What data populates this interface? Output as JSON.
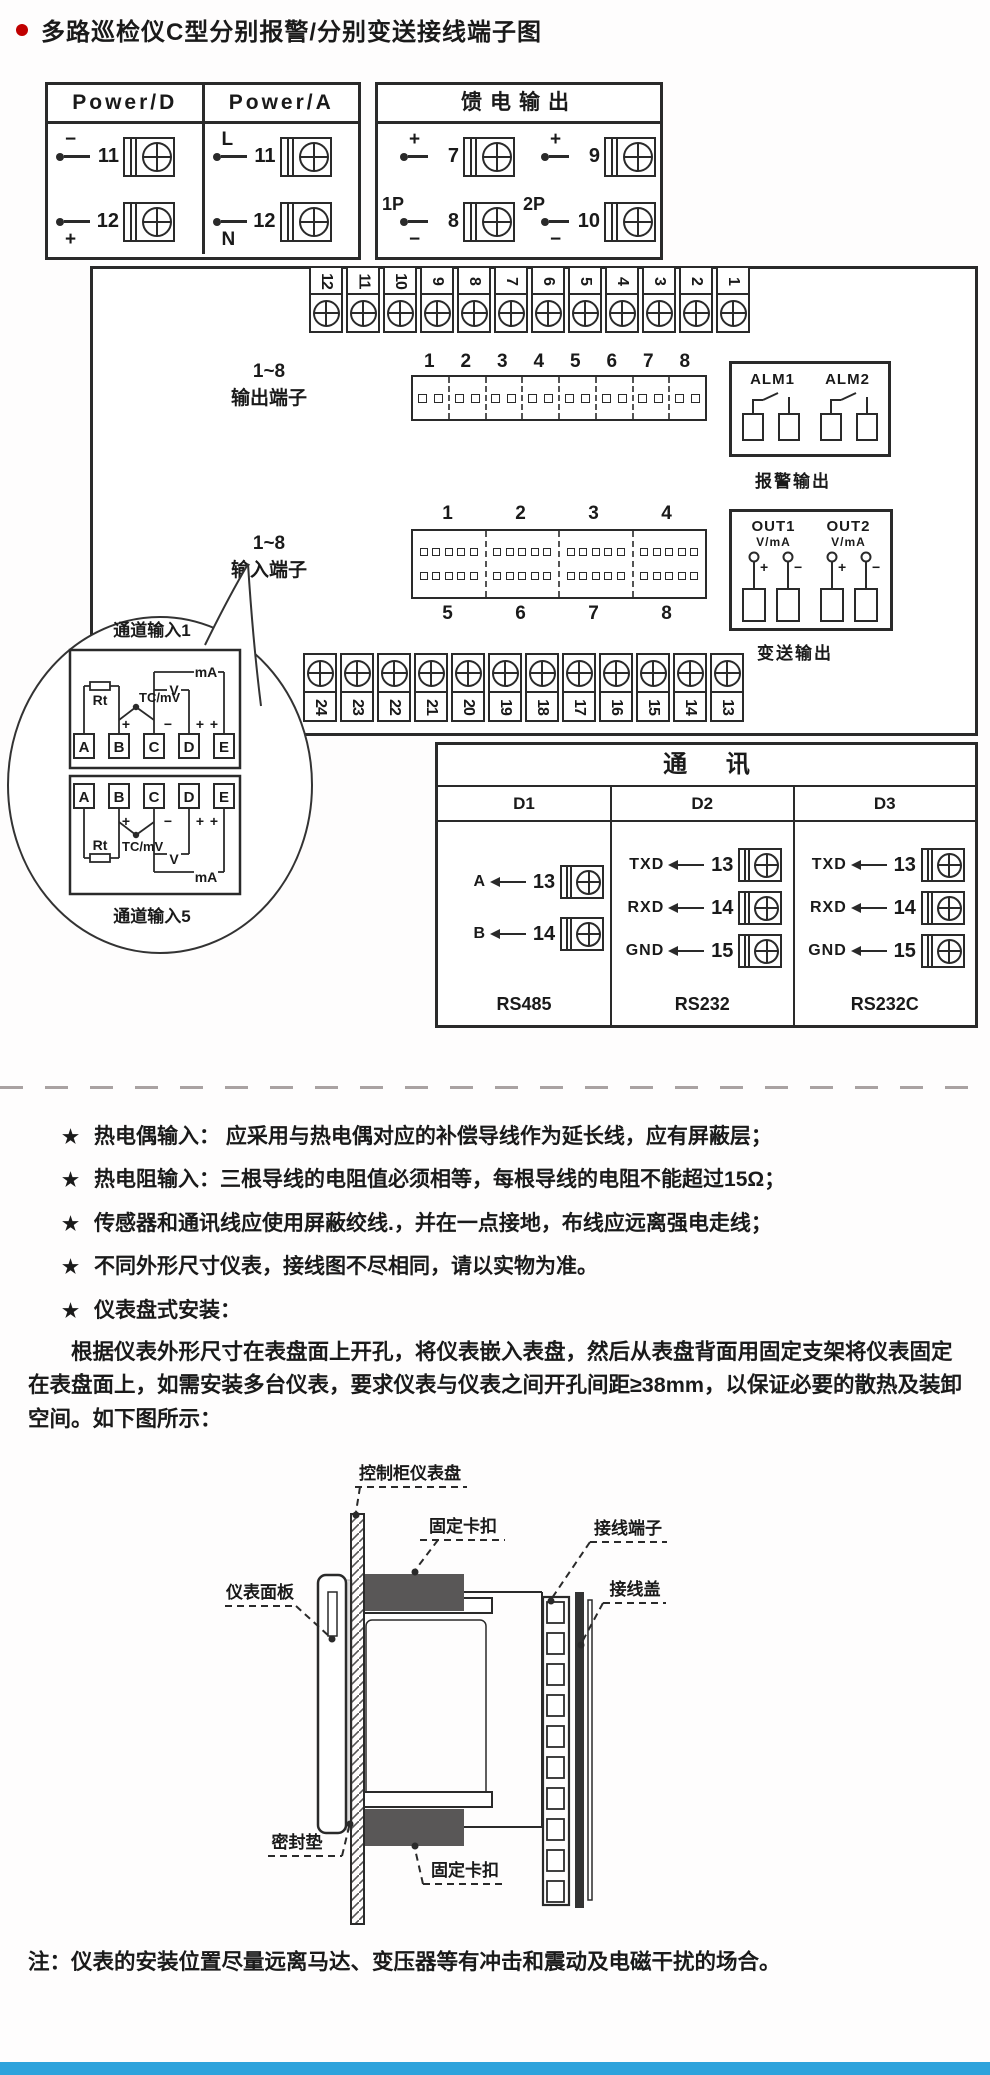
{
  "page": {
    "title": "多路巡检仪C型分别报警/分别变送接线端子图",
    "note": "注：仪表的安装位置尽量远离马达、变压器等有冲击和震动及电磁干扰的场合。",
    "accent_red": "#c00000",
    "bottom_bar_color": "#2ea3dc",
    "line_color": "#2a2a2a"
  },
  "power_box": {
    "headers": [
      "Power/D",
      "Power/A"
    ],
    "d_rows": [
      {
        "polarity": "−",
        "num": "11"
      },
      {
        "polarity": "+",
        "num": "12"
      }
    ],
    "a_rows": [
      {
        "polarity": "L",
        "num": "11"
      },
      {
        "polarity": "N",
        "num": "12"
      }
    ]
  },
  "feed_box": {
    "title": "馈电输出",
    "groups": [
      {
        "name": "1P",
        "rows": [
          {
            "polarity": "+",
            "num": "7"
          },
          {
            "polarity": "−",
            "num": "8"
          }
        ]
      },
      {
        "name": "2P",
        "rows": [
          {
            "polarity": "+",
            "num": "9"
          },
          {
            "polarity": "−",
            "num": "10"
          }
        ]
      }
    ]
  },
  "board": {
    "top_strip": [
      "12",
      "11",
      "10",
      "9",
      "8",
      "7",
      "6",
      "5",
      "4",
      "3",
      "2",
      "1"
    ],
    "bottom_strip": [
      "24",
      "23",
      "22",
      "21",
      "20",
      "19",
      "18",
      "17",
      "16",
      "15",
      "14",
      "13"
    ],
    "output_block": {
      "label_line1": "1~8",
      "label_line2": "输出端子",
      "numbers": [
        "1",
        "2",
        "3",
        "4",
        "5",
        "6",
        "7",
        "8"
      ]
    },
    "input_block": {
      "label_line1": "1~8",
      "label_line2": "输入端子",
      "top_numbers": [
        "1",
        "2",
        "3",
        "4"
      ],
      "bottom_numbers": [
        "5",
        "6",
        "7",
        "8"
      ]
    },
    "alarm_box": {
      "labels": [
        "ALM1",
        "ALM2"
      ],
      "caption": "报警输出"
    },
    "out_box": {
      "channels": [
        {
          "name": "OUT1",
          "unit": "V/mA"
        },
        {
          "name": "OUT2",
          "unit": "V/mA"
        }
      ],
      "plus": "+",
      "minus": "−",
      "caption": "变送输出"
    }
  },
  "balloon": {
    "top_label": "通道输入1",
    "bottom_label": "通道输入5",
    "terminals": [
      "A",
      "B",
      "C",
      "D",
      "E"
    ],
    "rt": "Rt",
    "tc": "TC/mV",
    "v": "V",
    "ma": "mA",
    "plus": "+",
    "minus": "−"
  },
  "comm_table": {
    "title": "通  讯",
    "columns": [
      {
        "header": "D1",
        "rows": [
          {
            "label": "A",
            "num": "13"
          },
          {
            "label": "B",
            "num": "14"
          }
        ],
        "caption": "RS485"
      },
      {
        "header": "D2",
        "rows": [
          {
            "label": "TXD",
            "num": "13"
          },
          {
            "label": "RXD",
            "num": "14"
          },
          {
            "label": "GND",
            "num": "15"
          }
        ],
        "caption": "RS232"
      },
      {
        "header": "D3",
        "rows": [
          {
            "label": "TXD",
            "num": "13"
          },
          {
            "label": "RXD",
            "num": "14"
          },
          {
            "label": "GND",
            "num": "15"
          }
        ],
        "caption": "RS232C"
      }
    ]
  },
  "notes_section": {
    "star": "★",
    "bullets": [
      "热电偶输入： 应采用与热电偶对应的补偿导线作为延长线，应有屏蔽层；",
      "热电阻输入：三根导线的电阻值必须相等，每根导线的电阻不能超过15Ω；",
      "传感器和通讯线应使用屏蔽绞线.，并在一点接地，布线应远离强电走线；",
      "不同外形尺寸仪表，接线图不尽相同，请以实物为准。",
      "仪表盘式安装："
    ],
    "paragraph": "根据仪表外形尺寸在表盘面上开孔，将仪表嵌入表盘，然后从表盘背面用固定支架将仪表固定在表盘面上，如需安装多台仪表，要求仪表与仪表之间开孔间距≥38mm，以保证必要的散热及装卸空间。如下图所示："
  },
  "install_diagram": {
    "labels": {
      "panel": "控制柜仪表盘",
      "clip_top": "固定卡扣",
      "terminal": "接线端子",
      "cover": "接线盖",
      "front_panel": "仪表面板",
      "gasket": "密封垫",
      "clip_bottom": "固定卡扣"
    }
  }
}
